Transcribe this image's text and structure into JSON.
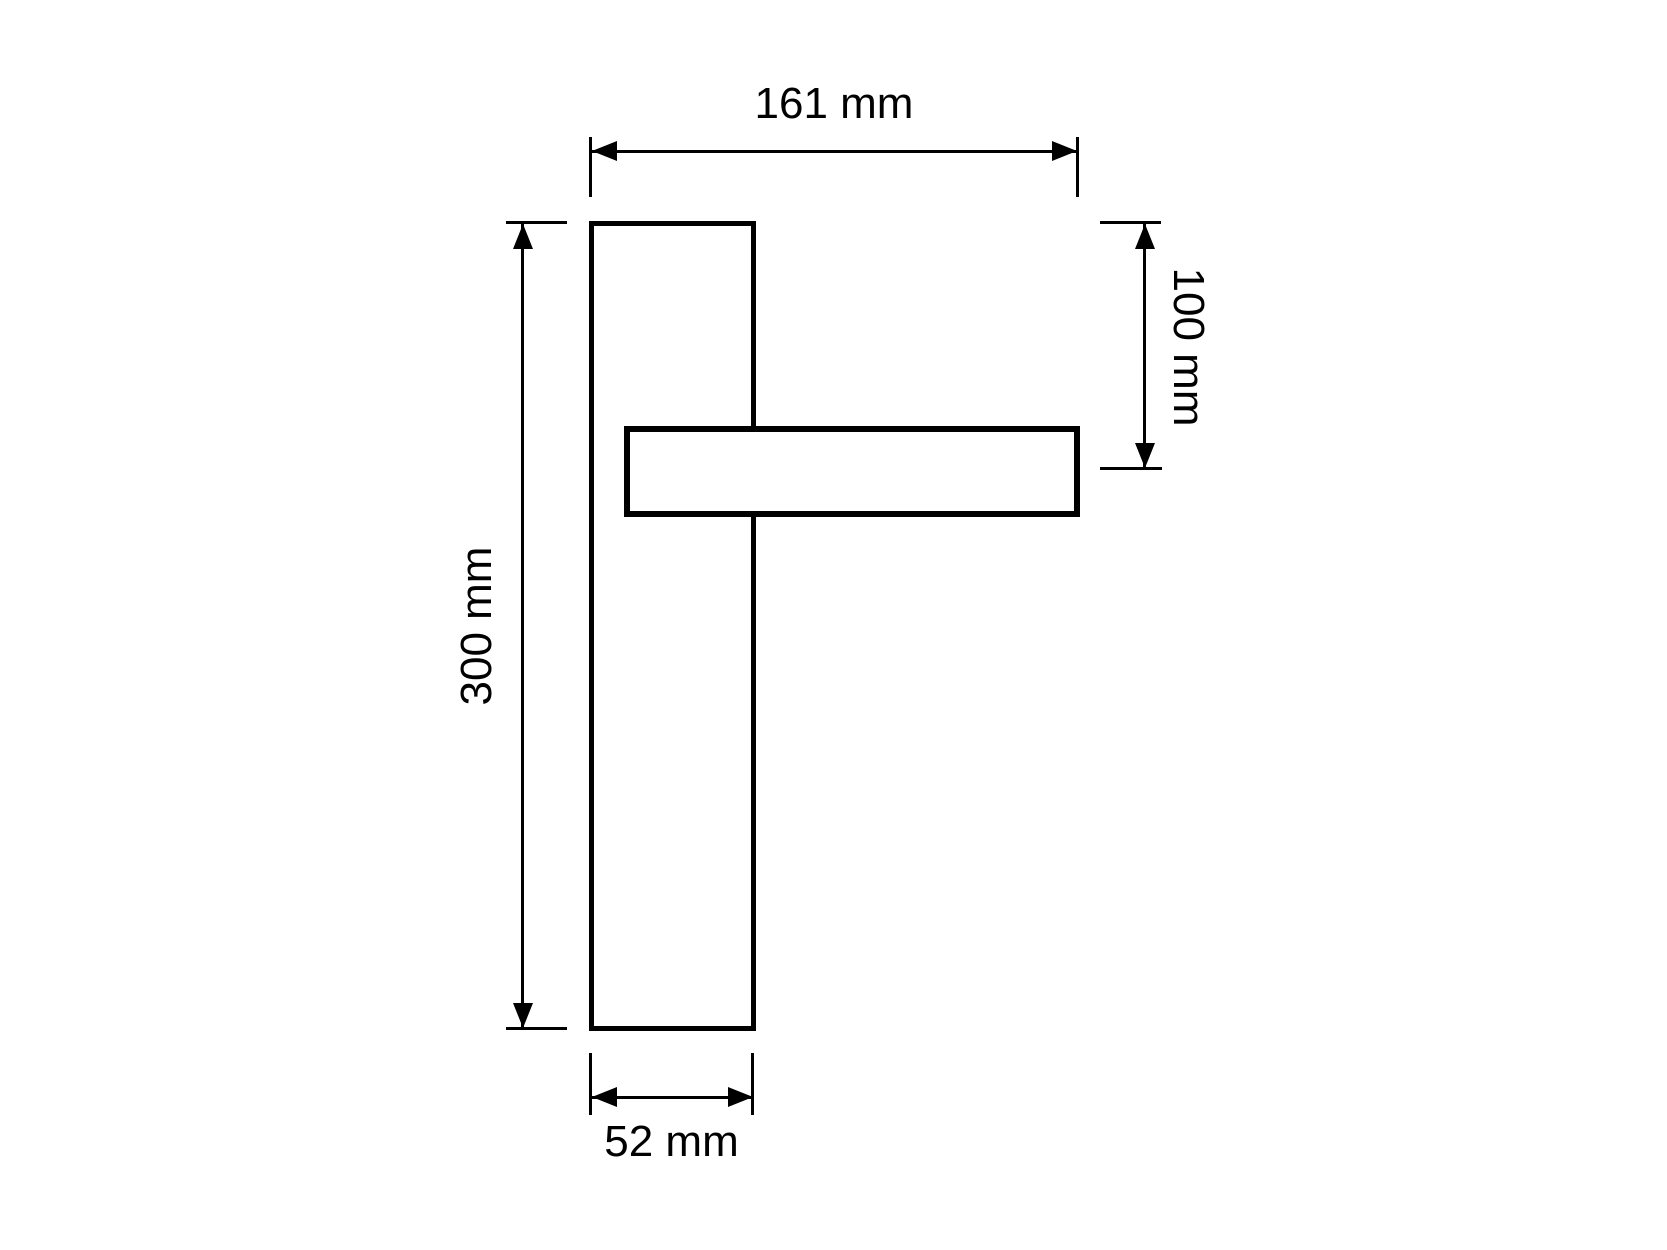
{
  "page": {
    "background_color": "#ffffff",
    "line_color": "#000000"
  },
  "drawing": {
    "type": "technical-dimension-drawing",
    "view": "front view of lever door handle on tall backplate",
    "shapes": [
      {
        "name": "backplate",
        "form": "tall vertical rectangle, outlined"
      },
      {
        "name": "lever-handle",
        "form": "horizontal rectangle overlapping right side of backplate"
      }
    ],
    "labels": {
      "total_width": "161 mm",
      "handle_axis_offset": "100 mm",
      "plate_height": "300 mm",
      "plate_width": "52 mm"
    },
    "dimensions": [
      {
        "label": "161 mm",
        "value": 161,
        "unit": "mm",
        "orientation": "horizontal",
        "text_rotation_deg": 0,
        "measures": "overall width from backplate left edge to lever tip"
      },
      {
        "label": "100 mm",
        "value": 100,
        "unit": "mm",
        "orientation": "vertical",
        "text_rotation_deg": 90,
        "measures": "distance from backplate top edge to lever centerline"
      },
      {
        "label": "300 mm",
        "value": 300,
        "unit": "mm",
        "orientation": "vertical",
        "text_rotation_deg": -90,
        "measures": "backplate height"
      },
      {
        "label": "52 mm",
        "value": 52,
        "unit": "mm",
        "orientation": "horizontal",
        "text_rotation_deg": 0,
        "measures": "backplate width"
      }
    ]
  }
}
